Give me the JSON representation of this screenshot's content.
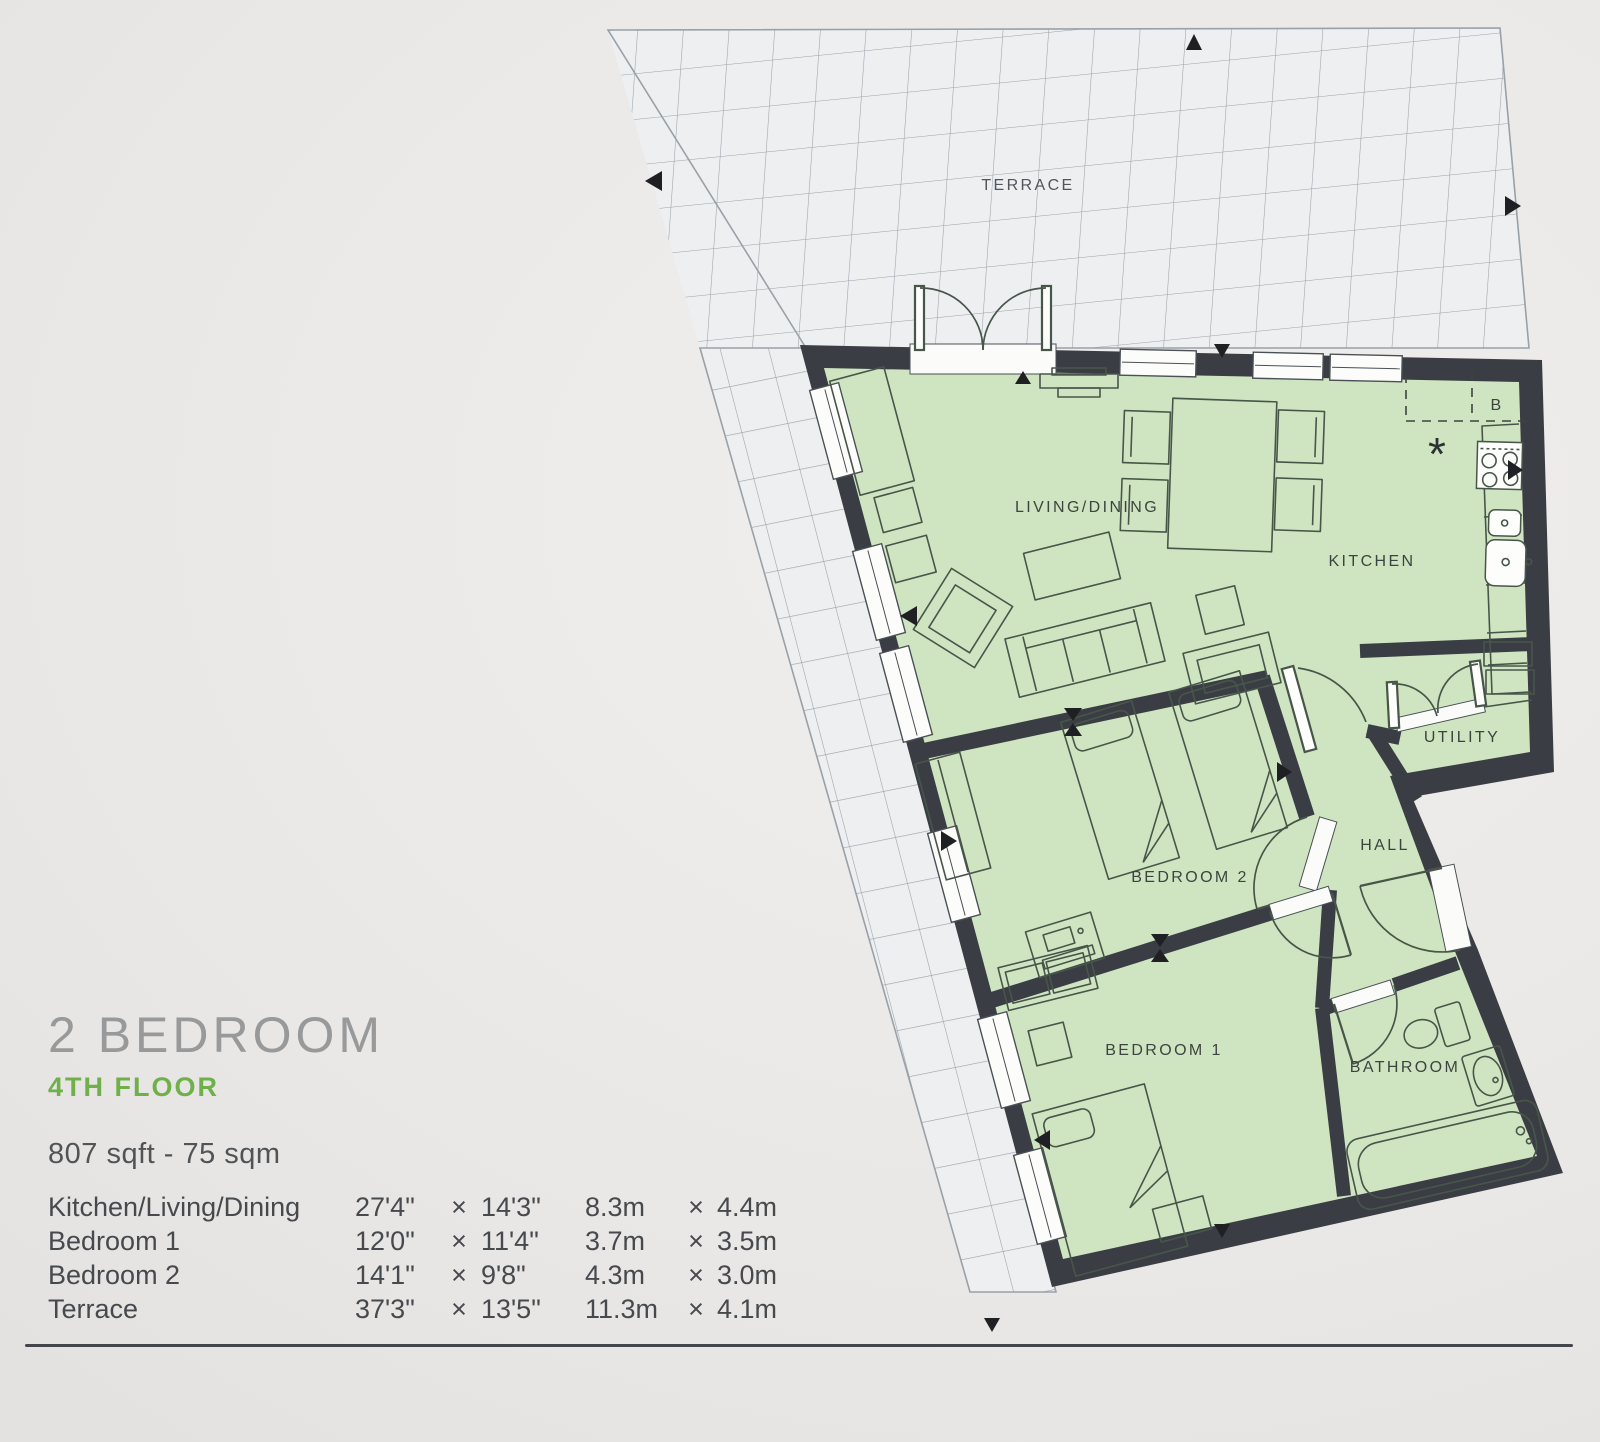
{
  "info": {
    "title": "2 BEDROOM",
    "floor": "4TH FLOOR",
    "area": "807 sqft - 75 sqm",
    "times": "×",
    "rooms": [
      {
        "name": "Kitchen/Living/Dining",
        "imp_w": "27'4\"",
        "imp_h": "14'3\"",
        "met_w": "8.3m",
        "met_h": "4.4m"
      },
      {
        "name": "Bedroom 1",
        "imp_w": "12'0\"",
        "imp_h": "11'4\"",
        "met_w": "3.7m",
        "met_h": "3.5m"
      },
      {
        "name": "Bedroom 2",
        "imp_w": "14'1\"",
        "imp_h": "9'8\"",
        "met_w": "4.3m",
        "met_h": "3.0m"
      },
      {
        "name": "Terrace",
        "imp_w": "37'3\"",
        "imp_h": "13'5\"",
        "met_w": "11.3m",
        "met_h": "4.1m"
      }
    ]
  },
  "plan": {
    "labels": {
      "terrace": "TERRACE",
      "living": "LIVING/DINING",
      "kitchen": "KITCHEN",
      "utility": "UTILITY",
      "hall": "HALL",
      "bedroom2": "BEDROOM 2",
      "bedroom1": "BEDROOM 1",
      "bathroom": "BATHROOM",
      "boiler": "B",
      "hob_marker": "*"
    },
    "colors": {
      "floor_green": "#cfe5c1",
      "wall": "#3a3e44",
      "terrace_fill": "#edeff1",
      "terrace_line": "#99a1a8",
      "furniture_line": "#48564a",
      "label_dark": "#3c443f",
      "accent_green": "#6fb04a",
      "title_gray": "#97999b",
      "text_dark": "#46494d",
      "window_line": "#4a5055",
      "marker": "#1e2023"
    }
  }
}
